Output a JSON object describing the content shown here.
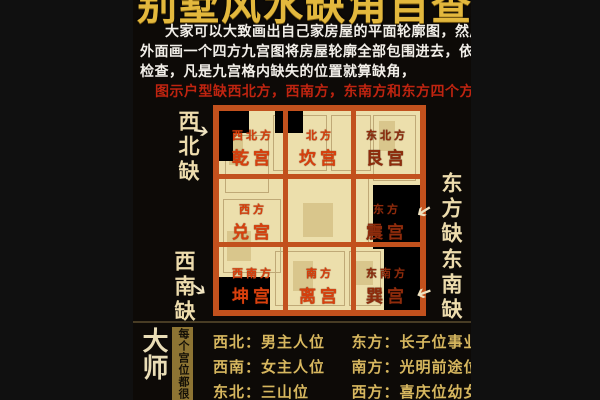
{
  "palette": {
    "outer_background": "#101010",
    "content_background": "#0d0a07",
    "grid_frame": "#c2511d",
    "floorplan": "#ecdfac",
    "missing_area": "#000000",
    "body_text": "#f2efe9",
    "highlight_text": "#bf2410",
    "label_bright": "#d8400d",
    "label_dark": "#8f2c0c",
    "gold_text": "#d7b75f",
    "cream_gold": "#eddcad",
    "title_gold": "#e3b83d"
  },
  "header": {
    "title_cropped": "别墅风水缺角自查",
    "body_lines": [
      "大家可以大致画出自己家房屋的平面轮廓图，然后轮廓",
      "外面画一个四方九宫图将房屋轮廓全部包围进去，依照下图",
      "检查，凡是九宫格内缺失的位置就算缺角，"
    ],
    "highlight_line": "图示户型缺西北方，西南方，东南方和东方四个方位。"
  },
  "grid": {
    "cells": [
      {
        "direction": "西北方",
        "palace": "乾宫"
      },
      {
        "direction": "北方",
        "palace": "坎宫"
      },
      {
        "direction": "东北方",
        "palace": "艮宫"
      },
      {
        "direction": "西方",
        "palace": "兑宫"
      },
      {
        "direction": "",
        "palace": ""
      },
      {
        "direction": "东方",
        "palace": "震宫"
      },
      {
        "direction": "西南方",
        "palace": "坤宫"
      },
      {
        "direction": "南方",
        "palace": "离宫"
      },
      {
        "direction": "东南方",
        "palace": "巽宫"
      }
    ],
    "callouts": [
      {
        "label": "西北缺",
        "arrow": "➔"
      },
      {
        "label": "西南缺",
        "arrow": "➔"
      },
      {
        "label": "东方缺",
        "arrow": "➔"
      },
      {
        "label": "东南缺",
        "arrow": "➔"
      }
    ]
  },
  "tips": {
    "heading": "大师提醒",
    "side_note": "每个宫位都很重",
    "rows": [
      {
        "left": "西北：男主人位",
        "right": "东方：长子位事业位"
      },
      {
        "left": "西南：女主人位",
        "right": "南方：光明前途位"
      },
      {
        "left": "东北：三山位",
        "right": "西方：喜庆位幼女位"
      }
    ]
  }
}
